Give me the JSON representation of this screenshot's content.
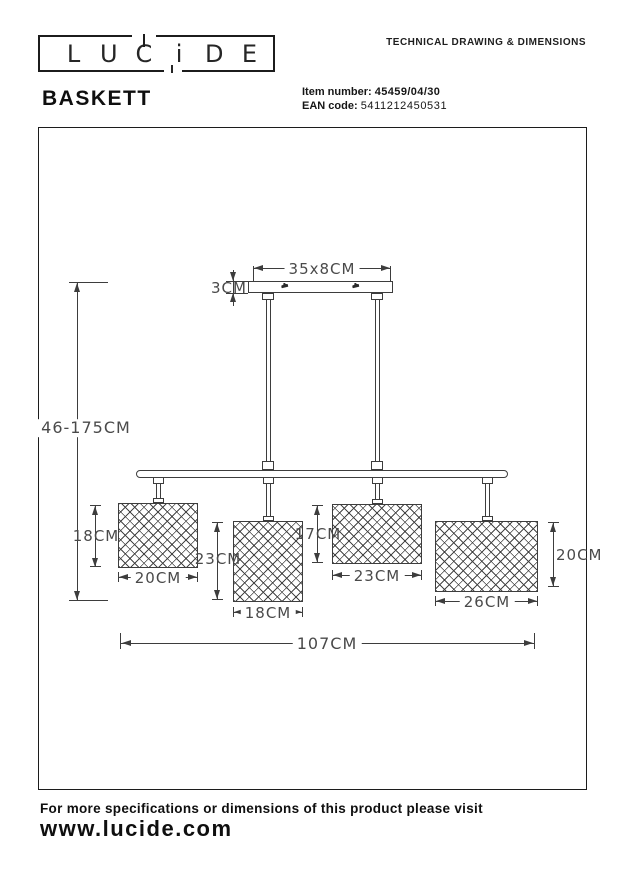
{
  "header": {
    "logo_letters": [
      "L",
      "U",
      "C",
      "i",
      "D",
      "E"
    ],
    "doc_title": "TECHNICAL DRAWING & DIMENSIONS",
    "product_name": "BASKETT",
    "item_label": "Item number:",
    "item_value": "45459/04/30",
    "ean_label": "EAN code:",
    "ean_value": "5411212450531"
  },
  "drawing": {
    "canopy_width": "35x8CM",
    "canopy_height": "3CM",
    "overall_height": "46-175CM",
    "overall_width": "107CM",
    "shades": [
      {
        "height": "18CM",
        "width": "20CM"
      },
      {
        "height": "23CM",
        "width": "18CM"
      },
      {
        "height": "17CM",
        "width": "23CM"
      },
      {
        "height": "20CM",
        "width": "26CM"
      }
    ]
  },
  "footer": {
    "note": "For more specifications or dimensions of this product please visit",
    "website": "www.lucide.com"
  },
  "colors": {
    "line": "#3d3d3d",
    "text": "#141414",
    "dim_text": "#4a4a4a"
  }
}
